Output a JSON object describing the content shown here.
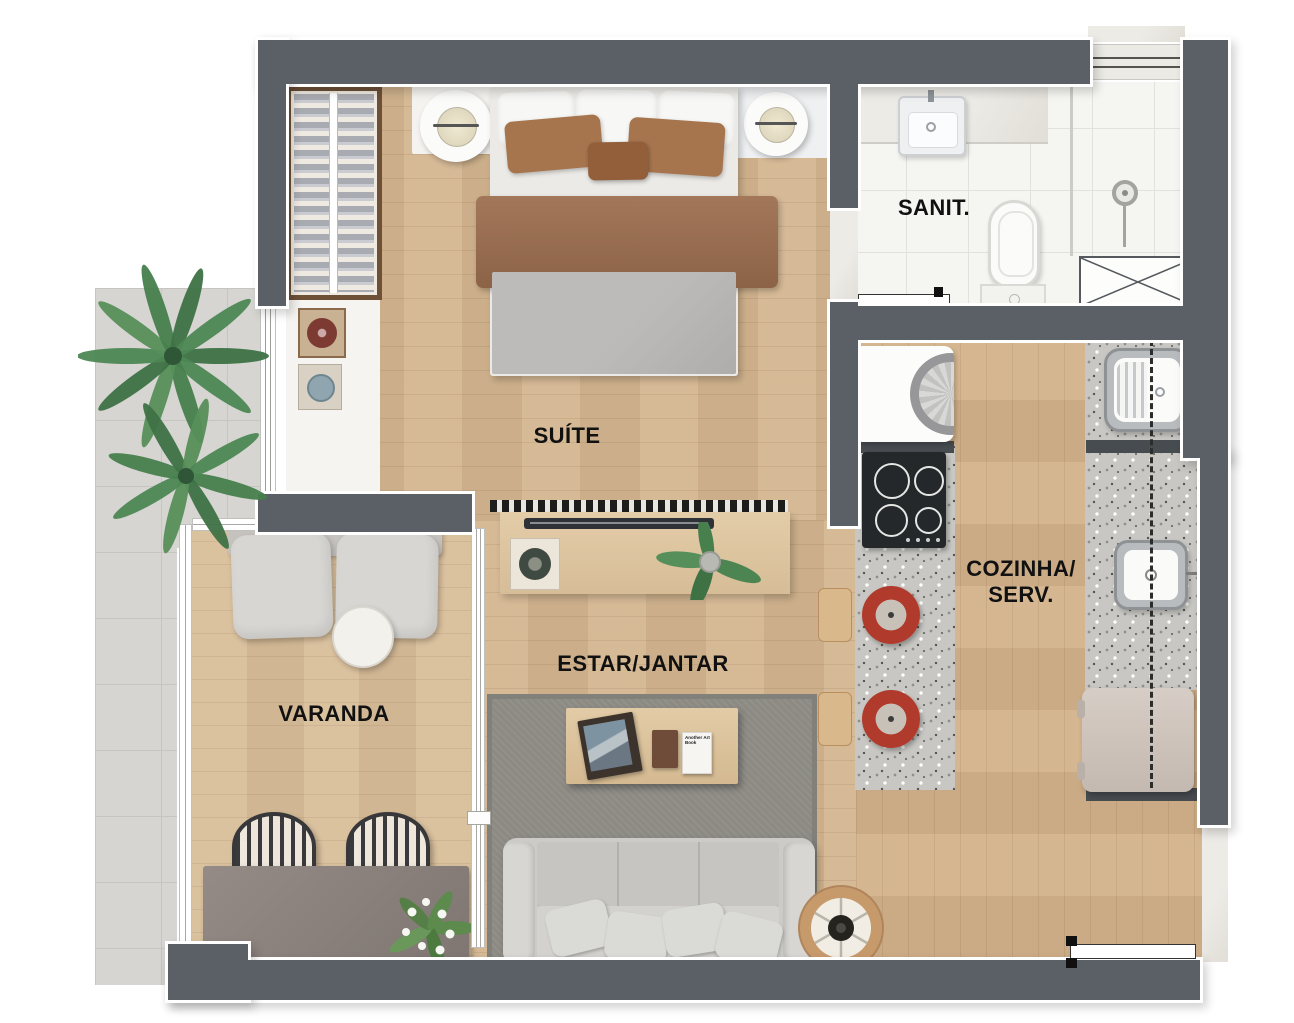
{
  "plan": {
    "type": "residential-floor-plan",
    "rooms": {
      "suite": {
        "label": "SUÍTE"
      },
      "sanit": {
        "label": "SANIT."
      },
      "cozinha_serv": {
        "label_line1": "COZINHA/",
        "label_line2": "SERV."
      },
      "estar_jantar": {
        "label": "ESTAR/JANTAR"
      },
      "varanda": {
        "label": "VARANDA"
      }
    },
    "decor": {
      "coffee_table_book_title": "Another Art Book"
    },
    "colors": {
      "wall": "#5a6065",
      "wall_outline": "#ffffff",
      "wood_floor": "#d4b690",
      "balcony_floor": "#d8bd98",
      "bathroom_tile": "#f5f5f2",
      "granite_counter": "#c8c7c3",
      "rug": "#8d8a84",
      "sofa": "#cccbc8",
      "blanket_brown": "#9b7155",
      "plant_green": "#47804d",
      "label_text": "#111111"
    }
  }
}
